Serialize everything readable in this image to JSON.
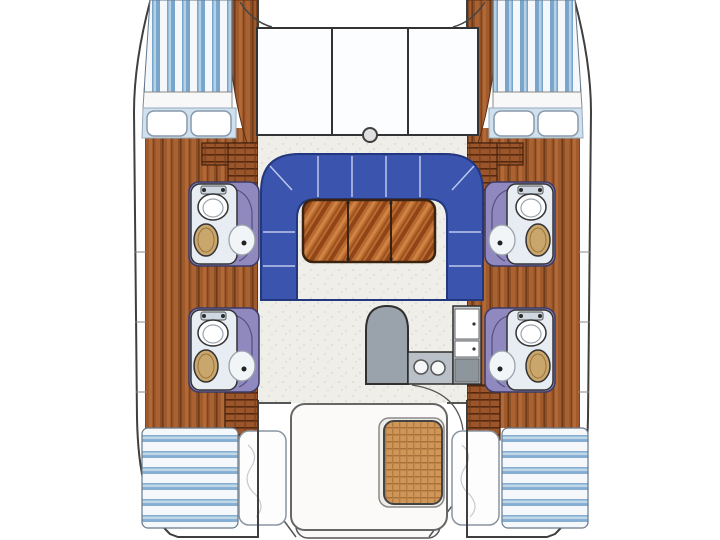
{
  "image": {
    "label": "Catamaran sailing yacht interior floor plan, top-down view, bow at top",
    "type": "boat-floorplan",
    "orientation": "bow-up"
  },
  "palette": {
    "background": "#ffffff",
    "outline": "#3f3f3f",
    "wood_floor": "#a05a2c",
    "mattress_stripe_blue": "#78a5cc",
    "settee_blue": "#3b55ae",
    "settee_edge": "#23377e",
    "bathroom_purple": "#9089c0",
    "sink_tan": "#c9a66b",
    "counter_gray": "#9aa2ab",
    "table_wood": "#b96a2f",
    "wicker_table_tan": "#cf9659",
    "pillow_white": "#fdfdfd"
  },
  "areas": {
    "foredeck": {
      "label": "Foredeck with three deck hatches",
      "hatch_count": 3
    },
    "mast": {
      "label": "Mast base fitting"
    },
    "bow_berth_port": {
      "label": "Port bow berth with striped mattress and two pillows",
      "pillows": 2
    },
    "bow_berth_starboard": {
      "label": "Starboard bow berth with striped mattress and two pillows",
      "pillows": 2
    },
    "salon": {
      "label": "Salon with U-shaped blue settee and three-leaf wood table",
      "table_leaves": 3
    },
    "bathroom_port_forward": {
      "label": "Port forward head with toilet, sink and shower"
    },
    "bathroom_port_aft": {
      "label": "Port aft head with toilet, sink and shower"
    },
    "bathroom_starboard_forward": {
      "label": "Starboard forward head with toilet, sink and shower"
    },
    "bathroom_starboard_aft": {
      "label": "Starboard aft head with toilet, sink and shower"
    },
    "galley": {
      "label": "Galley with rounded counter, twin round sinks, refrigerator and stove",
      "sink_basins": 2
    },
    "cockpit": {
      "label": "Aft cockpit with wraparound bench seating and wicker table"
    },
    "aft_berth_port": {
      "label": "Port aft berth with striped mattress and pillow",
      "pillows": 1
    },
    "aft_berth_starboard": {
      "label": "Starboard aft berth with striped mattress and pillow",
      "pillows": 1
    },
    "transom": {
      "label": "Transom platform and davit lines between hulls"
    }
  }
}
